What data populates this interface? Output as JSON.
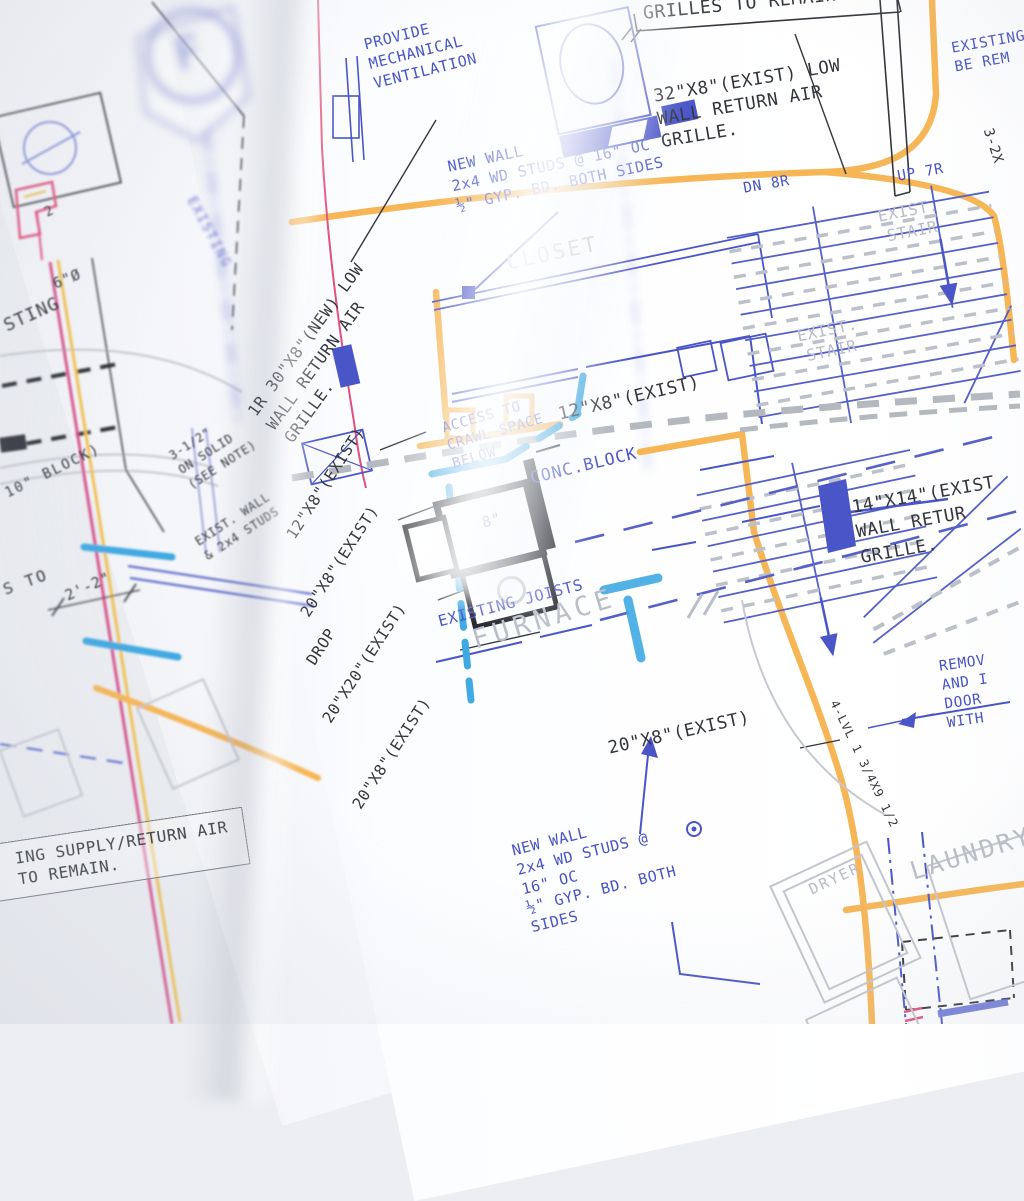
{
  "palette": {
    "paper": "#fbfcfe",
    "ink_black": "#33363d",
    "ink_blue": "#4753c6",
    "ink_cyan": "#3fa9e2",
    "ink_orange": "#f7b656",
    "ink_gray": "#b9bdc8",
    "ink_red": "#e0507a",
    "ink_yellow": "#f2c14e"
  },
  "stamp": {
    "letter": "F"
  },
  "right": {
    "grilles_banner": "GRILLES TO REMAIN",
    "vent": {
      "l1": "PROVIDE",
      "l2": "MECHANICAL",
      "l3": "VENTILATION"
    },
    "grille32": {
      "l1": "32\"X8\"(EXIST) LOW",
      "l2": "WALL RETURN AIR",
      "l3": "GRILLE."
    },
    "newwall_top": {
      "l1": "NEW WALL",
      "l2": "2x4 WD STUDS @ 16\" OC",
      "l3": "½\" GYP. BD. BOTH SIDES"
    },
    "stair_dn": "DN 8R",
    "stair_up": "UP 7R",
    "exist_stair_upper": {
      "l1": "EXIST.",
      "l2": "STAIR"
    },
    "exist_stair_lower": {
      "l1": "EXIST.",
      "l2": "STAIR"
    },
    "existing_be": {
      "l1": "EXISTING",
      "l2": "BE REM"
    },
    "dim_3_2x": "3-2X",
    "grille30": {
      "l1": "1R 30\"X8\"(NEW) LOW",
      "l2": "WALL RETURN AIR",
      "l3": "GRILLE."
    },
    "closet": "CLOSET",
    "access": {
      "l1": "ACCESS TO",
      "l2": "CRAWL SPACE",
      "l3": "BELOW"
    },
    "duct12_note": "12\"X8\"(EXIST)",
    "conc_block": "CONC.BLOCK",
    "grille14": {
      "l1": "14\"X14\"(EXIST",
      "l2": "WALL RETUR",
      "l3": "GRILLE."
    },
    "riser_labels": [
      "12\"X8\"(EXIST)",
      "20\"X8\"(EXIST)",
      "DROP",
      "20\"X20\"(EXIST)",
      "20\"X8\"(EXIST)"
    ],
    "duct8": "8\"",
    "joists": "EXISTING JOISTS",
    "furnace": "FURNACE",
    "remove_note": {
      "l1": "REMOV",
      "l2": "AND I",
      "l3": "DOOR",
      "l4": "WITH"
    },
    "duct20_note": "20\"X8\"(EXIST)",
    "lvl_callout": "4-LVL 1 3/4X9 1/2",
    "newwall_bottom": {
      "l1": "NEW WALL",
      "l2": "2x4 WD STUDS @",
      "l3": "16\" OC",
      "l4": "½\" GYP. BD. BOTH",
      "l5": "SIDES"
    },
    "dryer": "DRYER",
    "laundry": "LAUNDRY"
  },
  "left": {
    "dia6": "6\"Ø",
    "existing_frag": "STING",
    "block10": "10\" BLOCK)",
    "dim22": "2'-2\"",
    "note312": {
      "l1": "3-1/2\"",
      "l2": "ON SOLID",
      "l3": "(SEE NOTE)"
    },
    "wall_note": {
      "l1": "EXIST. WALL",
      "l2": "& 2x4 STUDS"
    },
    "s_to": "S TO",
    "flag_num": "2",
    "spine_text": "EXISTING",
    "supply_box": {
      "l1": "ING SUPPLY/RETURN AIR",
      "l2": "TO REMAIN."
    }
  }
}
